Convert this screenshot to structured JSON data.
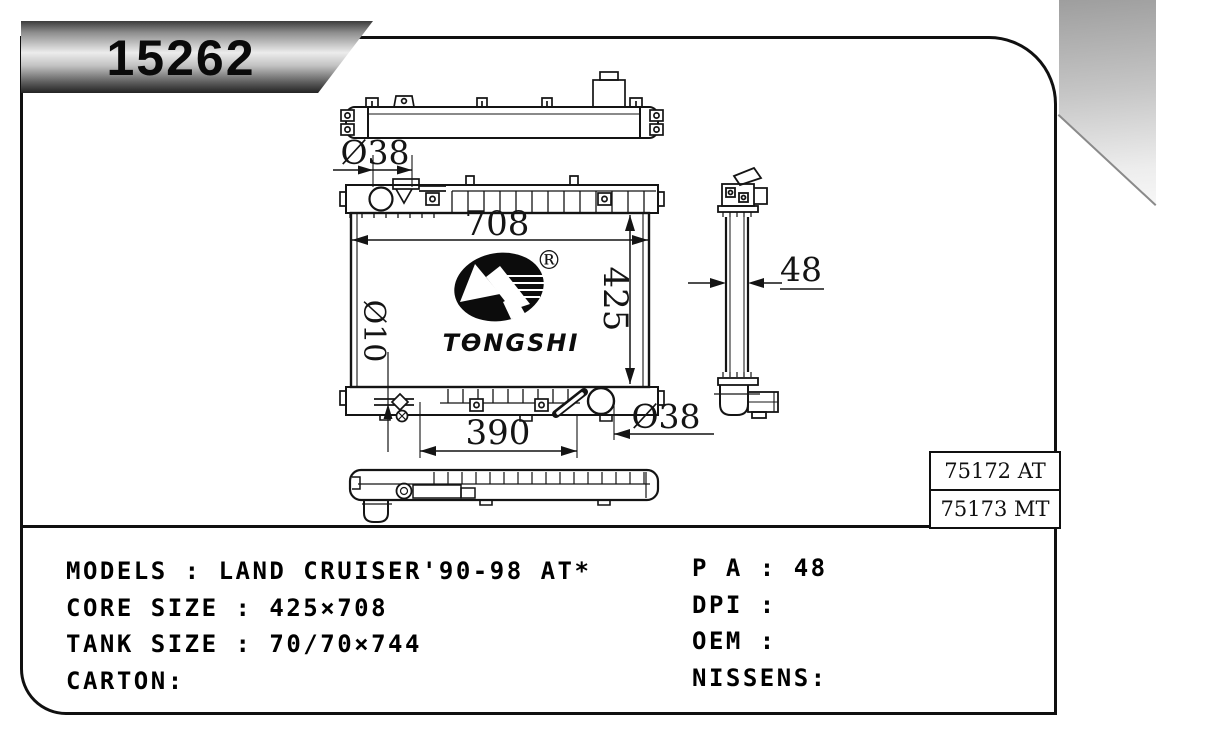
{
  "badge": {
    "part_number": "15262"
  },
  "logo": {
    "brand": "TONGSHI",
    "registered_mark": "®"
  },
  "drawing": {
    "dimensions": {
      "filler_neck_diameter": "Ø38",
      "core_width": "708",
      "core_height": "425",
      "drain_diameter": "Ø10",
      "outlet_span": "390",
      "outlet_diameter": "Ø38",
      "core_thickness": "48"
    }
  },
  "reference_table": {
    "rows": [
      {
        "code": "75172 AT"
      },
      {
        "code": "75173 MT"
      }
    ]
  },
  "specs": {
    "left_rows": [
      {
        "label": "MODELS",
        "sep": " : ",
        "value": "LAND CRUISER'90-98 AT*"
      },
      {
        "label": "CORE SIZE",
        "sep": " : ",
        "value": "425×708"
      },
      {
        "label": "TANK SIZE",
        "sep": " : ",
        "value": "70/70×744"
      },
      {
        "label": "CARTON",
        "sep": ":",
        "value": ""
      }
    ],
    "right_rows": [
      {
        "label": "P A",
        "sep": " : ",
        "value": "48"
      },
      {
        "label": "DPI",
        "sep": " : ",
        "value": ""
      },
      {
        "label": "OEM",
        "sep": " : ",
        "value": ""
      },
      {
        "label": "NISSENS",
        "sep": ":",
        "value": ""
      }
    ]
  }
}
